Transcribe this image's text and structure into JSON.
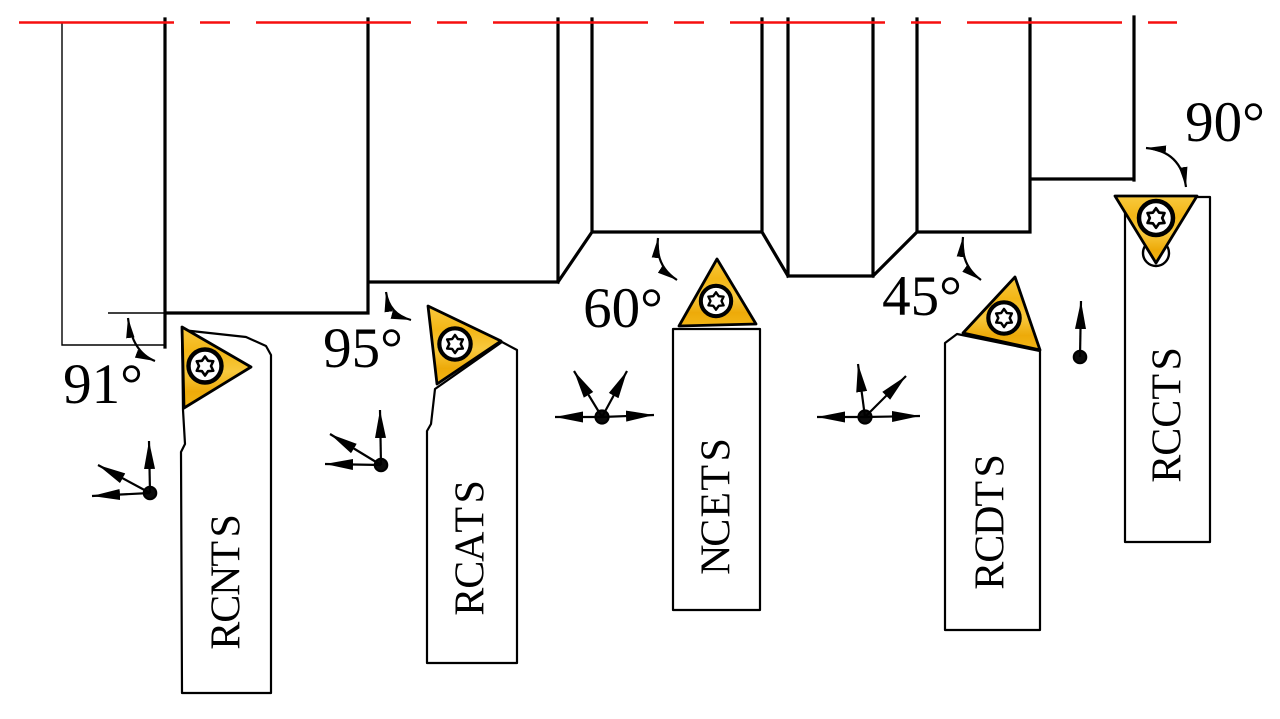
{
  "diagram": {
    "tools": [
      {
        "id": "stncr",
        "label": "STNCR",
        "lead_angle": "91°",
        "feed_directions": [
          "up",
          "left",
          "up-left"
        ]
      },
      {
        "id": "stacr",
        "label": "STACR",
        "lead_angle": "95°",
        "feed_directions": [
          "up",
          "left",
          "up-left"
        ]
      },
      {
        "id": "stecn",
        "label": "STECN",
        "lead_angle": "60°",
        "feed_directions": [
          "left",
          "right",
          "up-left",
          "up-right"
        ]
      },
      {
        "id": "stdcr",
        "label": "STDCR",
        "lead_angle": "45°",
        "feed_directions": [
          "left",
          "right",
          "up",
          "up-right"
        ]
      },
      {
        "id": "stccr",
        "label": "STCCR",
        "lead_angle": "90°",
        "feed_directions": [
          "up"
        ]
      }
    ],
    "colors": {
      "centerline_red": "#f60f0f",
      "insert_gold_light": "#f8c93e",
      "insert_gold": "#f3b616",
      "insert_gold_dark": "#edaa09",
      "line_black": "#000000"
    }
  }
}
